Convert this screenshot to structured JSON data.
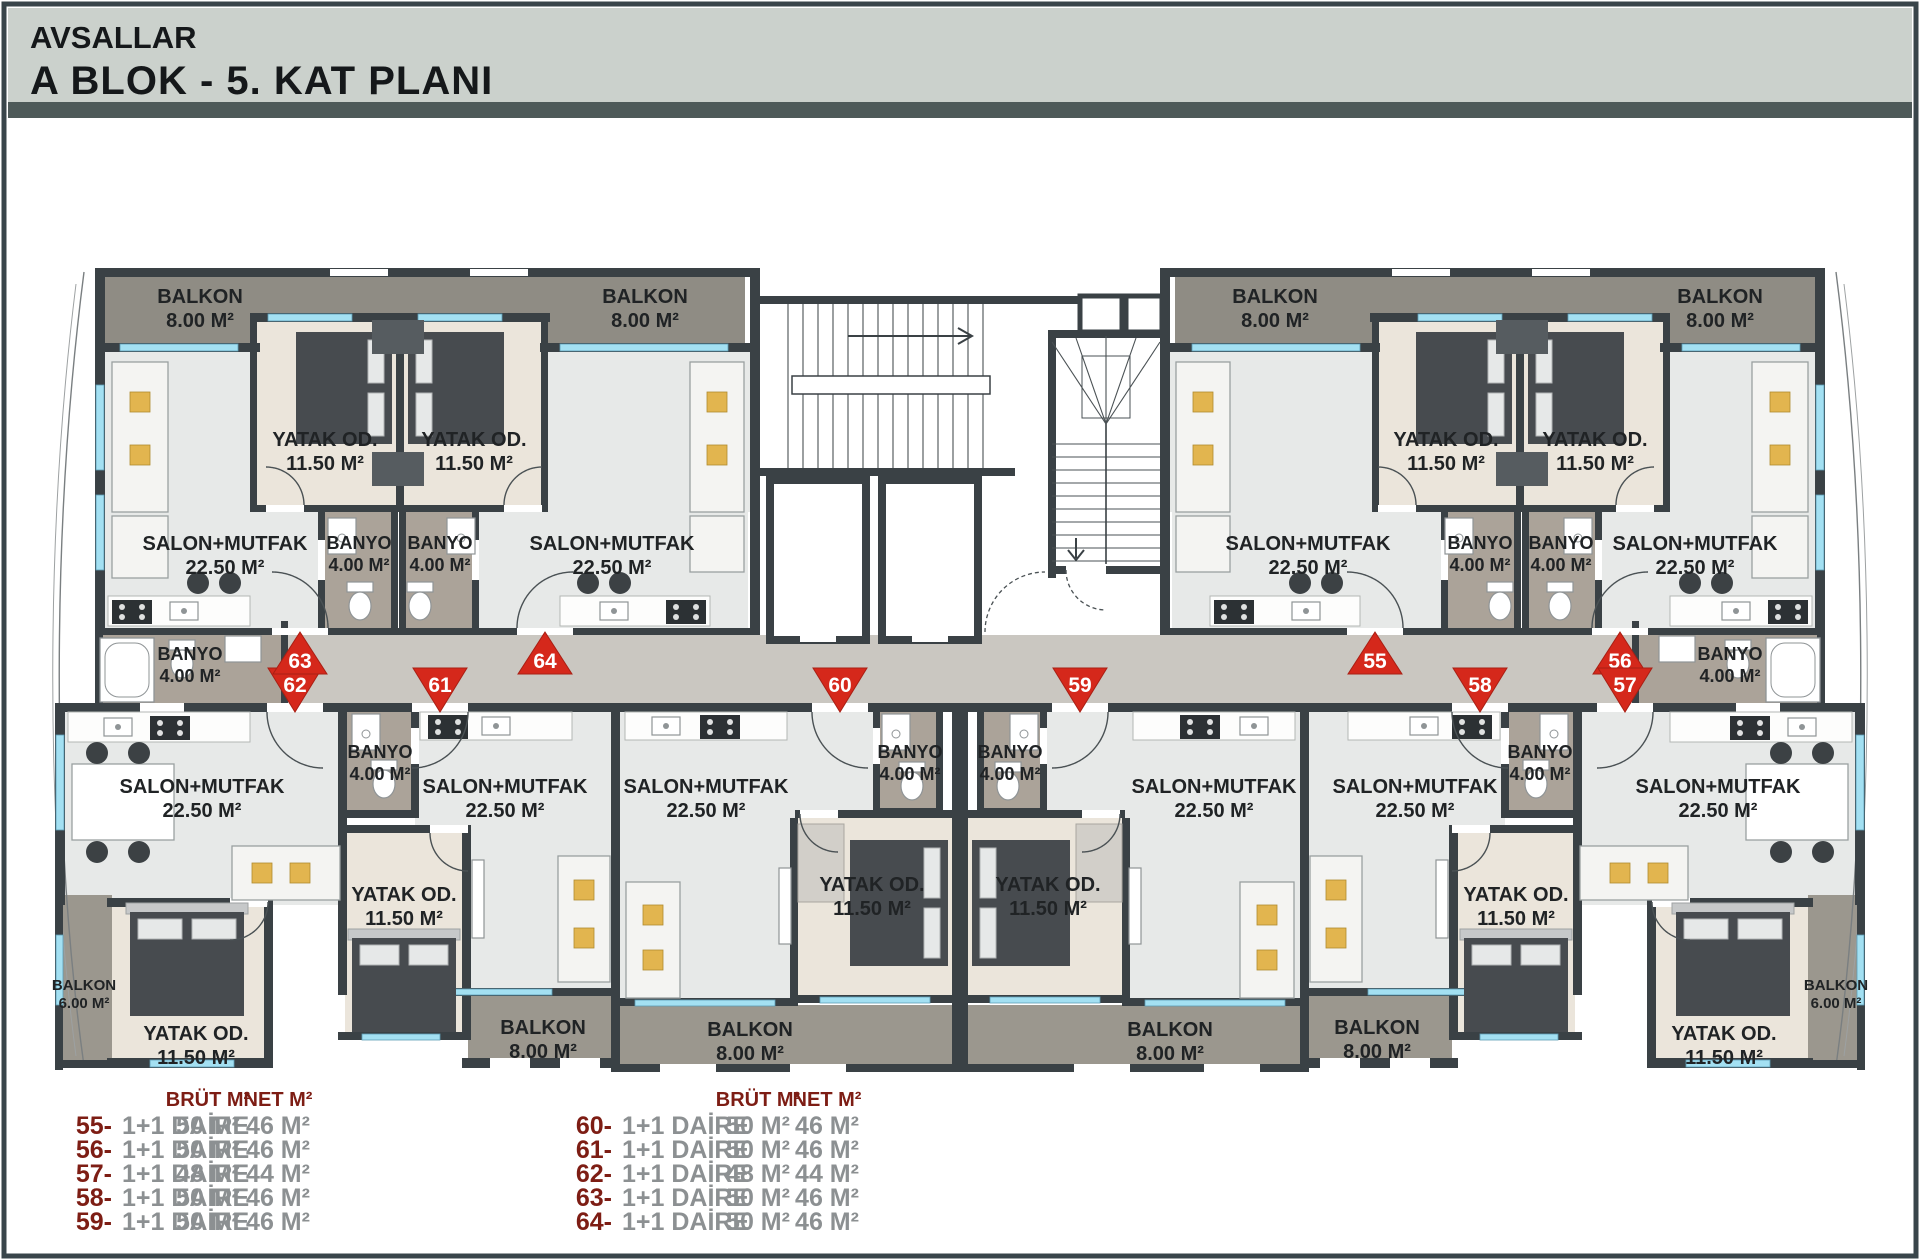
{
  "header": {
    "project": "AVSALLAR",
    "block_title": "A BLOK  -  5. KAT PLANI"
  },
  "plan": {
    "rooms": [
      {
        "id": "balkon-63",
        "name": "BALKON",
        "area": "8.00 M²"
      },
      {
        "id": "balkon-64",
        "name": "BALKON",
        "area": "8.00 M²"
      },
      {
        "id": "balkon-55",
        "name": "BALKON",
        "area": "8.00 M²"
      },
      {
        "id": "balkon-56",
        "name": "BALKON",
        "area": "8.00 M²"
      },
      {
        "id": "yatak-63",
        "name": "YATAK OD.",
        "area": "11.50 M²"
      },
      {
        "id": "yatak-64",
        "name": "YATAK OD.",
        "area": "11.50 M²"
      },
      {
        "id": "yatak-55",
        "name": "YATAK OD.",
        "area": "11.50 M²"
      },
      {
        "id": "yatak-56",
        "name": "YATAK OD.",
        "area": "11.50 M²"
      },
      {
        "id": "salon-63",
        "name": "SALON+MUTFAK",
        "area": "22.50 M²"
      },
      {
        "id": "salon-64",
        "name": "SALON+MUTFAK",
        "area": "22.50 M²"
      },
      {
        "id": "salon-55",
        "name": "SALON+MUTFAK",
        "area": "22.50 M²"
      },
      {
        "id": "salon-56",
        "name": "SALON+MUTFAK",
        "area": "22.50 M²"
      },
      {
        "id": "banyo-63",
        "name": "BANYO",
        "area": "4.00 M²"
      },
      {
        "id": "banyo-64",
        "name": "BANYO",
        "area": "4.00 M²"
      },
      {
        "id": "banyo-55",
        "name": "BANYO",
        "area": "4.00 M²"
      },
      {
        "id": "banyo-56",
        "name": "BANYO",
        "area": "4.00 M²"
      },
      {
        "id": "banyo-62",
        "name": "BANYO",
        "area": "4.00 M²"
      },
      {
        "id": "banyo-57",
        "name": "BANYO",
        "area": "4.00 M²"
      },
      {
        "id": "banyo-61",
        "name": "BANYO",
        "area": "4.00 M²"
      },
      {
        "id": "banyo-60",
        "name": "BANYO",
        "area": "4.00 M²"
      },
      {
        "id": "banyo-59",
        "name": "BANYO",
        "area": "4.00 M²"
      },
      {
        "id": "banyo-58",
        "name": "BANYO",
        "area": "4.00 M²"
      },
      {
        "id": "salon-62",
        "name": "SALON+MUTFAK",
        "area": "22.50 M²"
      },
      {
        "id": "salon-61",
        "name": "SALON+MUTFAK",
        "area": "22.50 M²"
      },
      {
        "id": "salon-60",
        "name": "SALON+MUTFAK",
        "area": "22.50 M²"
      },
      {
        "id": "salon-59",
        "name": "SALON+MUTFAK",
        "area": "22.50 M²"
      },
      {
        "id": "salon-58",
        "name": "SALON+MUTFAK",
        "area": "22.50 M²"
      },
      {
        "id": "salon-57",
        "name": "SALON+MUTFAK",
        "area": "22.50 M²"
      },
      {
        "id": "yatak-62",
        "name": "YATAK OD.",
        "area": "11.50 M²"
      },
      {
        "id": "yatak-61",
        "name": "YATAK OD.",
        "area": "11.50 M²"
      },
      {
        "id": "yatak-60",
        "name": "YATAK OD.",
        "area": "11.50 M²"
      },
      {
        "id": "yatak-59",
        "name": "YATAK OD.",
        "area": "11.50 M²"
      },
      {
        "id": "yatak-58",
        "name": "YATAK OD.",
        "area": "11.50 M²"
      },
      {
        "id": "yatak-57",
        "name": "YATAK OD.",
        "area": "11.50 M²"
      },
      {
        "id": "balkon-62",
        "name": "BALKON",
        "area": "6.00 M²"
      },
      {
        "id": "balkon-57",
        "name": "BALKON",
        "area": "6.00 M²"
      },
      {
        "id": "balkon-61",
        "name": "BALKON",
        "area": "8.00 M²"
      },
      {
        "id": "balkon-60",
        "name": "BALKON",
        "area": "8.00 M²"
      },
      {
        "id": "balkon-59",
        "name": "BALKON",
        "area": "8.00 M²"
      },
      {
        "id": "balkon-58",
        "name": "BALKON",
        "area": "8.00 M²"
      }
    ],
    "markers": [
      {
        "no": "55"
      },
      {
        "no": "56"
      },
      {
        "no": "57"
      },
      {
        "no": "58"
      },
      {
        "no": "59"
      },
      {
        "no": "60"
      },
      {
        "no": "61"
      },
      {
        "no": "62"
      },
      {
        "no": "63"
      },
      {
        "no": "64"
      }
    ]
  },
  "legend": {
    "col_headers": {
      "brut": "BRÜT M²",
      "net": "NET M²"
    },
    "columns": [
      {
        "rows": [
          {
            "no": "55-",
            "type": "1+1 DAİRE",
            "brut": "50 M²",
            "net": "46 M²"
          },
          {
            "no": "56-",
            "type": "1+1 DAİRE",
            "brut": "50 M²",
            "net": "46 M²"
          },
          {
            "no": "57-",
            "type": "1+1 DAİRE",
            "brut": "48 M²",
            "net": "44 M²"
          },
          {
            "no": "58-",
            "type": "1+1 DAİRE",
            "brut": "50 M²",
            "net": "46 M²"
          },
          {
            "no": "59-",
            "type": "1+1 DAİRE",
            "brut": "50 M²",
            "net": "46 M²"
          }
        ]
      },
      {
        "rows": [
          {
            "no": "60-",
            "type": "1+1 DAİRE",
            "brut": "50 M²",
            "net": "46 M²"
          },
          {
            "no": "61-",
            "type": "1+1 DAİRE",
            "brut": "50 M²",
            "net": "46 M²"
          },
          {
            "no": "62-",
            "type": "1+1 DAİRE",
            "brut": "48 M²",
            "net": "44 M²"
          },
          {
            "no": "63-",
            "type": "1+1 DAİRE",
            "brut": "50 M²",
            "net": "46 M²"
          },
          {
            "no": "64-",
            "type": "1+1 DAİRE",
            "brut": "50 M²",
            "net": "46 M²"
          }
        ]
      }
    ]
  },
  "colors": {
    "wall": "#3a4145",
    "salon_floor": "#e7e9e8",
    "bedroom_floor": "#ebe5db",
    "balcony_floor": "#8f8c84",
    "balcony_floor_light": "#9b978e",
    "bath_floor": "#aba399",
    "corridor_floor": "#cac7c1",
    "window": "#a3e0f2",
    "marker_red": "#d5281b",
    "accent_yellow": "#e2b54f",
    "legend_red": "#7d1d14",
    "legend_gray": "#8c9092",
    "header_bg": "#cbd1cc",
    "divider": "#4e5a59"
  }
}
